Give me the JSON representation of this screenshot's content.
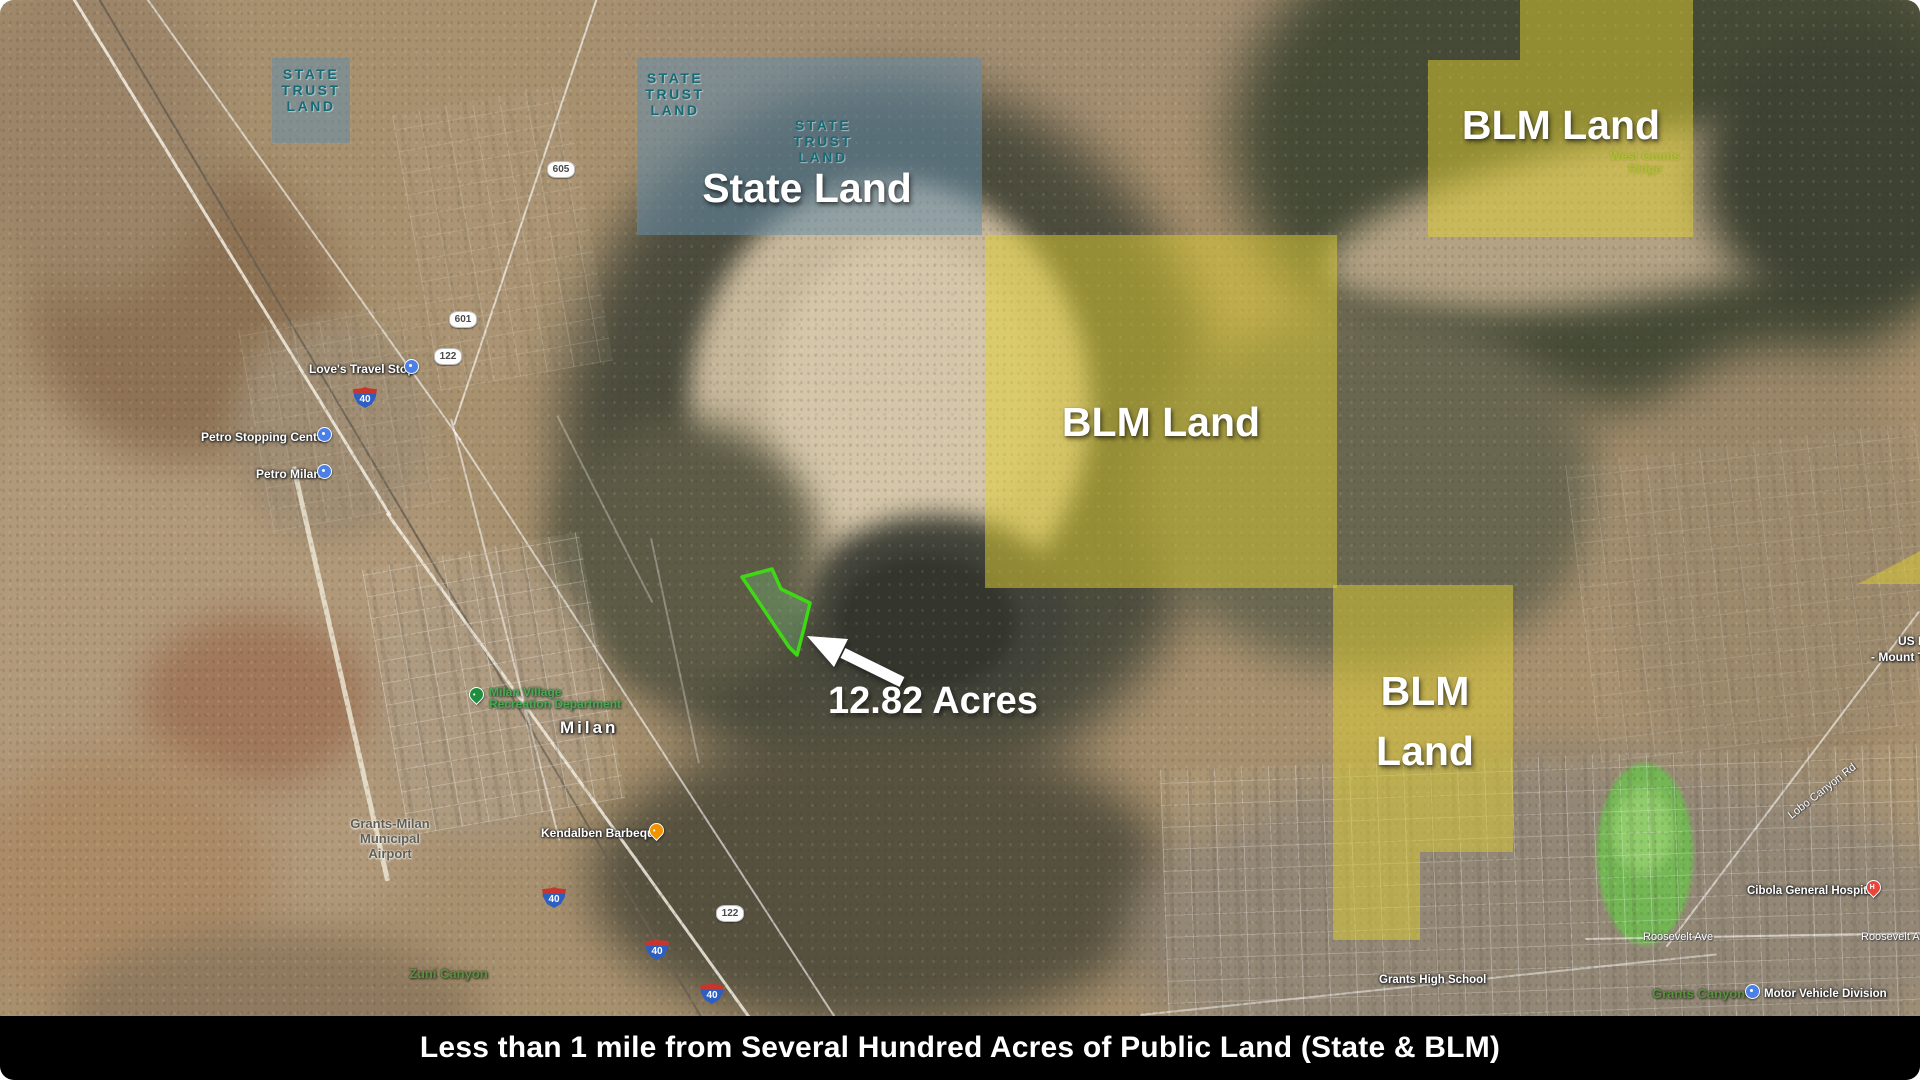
{
  "title_overlays": {
    "state_trust_lines": [
      "STATE",
      "TRUST",
      "LAND"
    ],
    "state_land": "State Land",
    "blm_center": "BLM Land",
    "blm_top_right": "BLM Land",
    "blm_right": [
      "BLM",
      "Land"
    ],
    "parcel_acreage": "12.82 Acres"
  },
  "caption": {
    "text": "Less than 1 mile from Several Hundred Acres of Public Land (State & BLM)"
  },
  "map_labels": {
    "loves_travel_stop": "Love's Travel Stop",
    "petro_stopping_center": "Petro Stopping Center",
    "petro_milan": "Petro Milan",
    "milan_rec_line1": "Milan Village",
    "milan_rec_line2": "Recreation Department",
    "milan": "Milan",
    "airport_line1": "Grants-Milan",
    "airport_line2": "Municipal",
    "airport_line3": "Airport",
    "kendalben": "Kendalben Barbeque",
    "zuni_canyon": "Zuni Canyon",
    "grants_high_school": "Grants High School",
    "cibola_hospital": "Cibola General Hospital",
    "roosevelt_ave": "Roosevelt Ave",
    "grants_canyon": "Grants Canyon",
    "motor_vehicle_division": "Motor Vehicle Division",
    "west_grants_ridge_line1": "West Grants",
    "west_grants_ridge_line2": "Ridge",
    "us_highway_fragment": "US F",
    "mount_taylor_fragment": "- Mount Ta",
    "lobo_canyon_rd": "Lobo Canyon Rd"
  },
  "shields": {
    "interstate_40": "40",
    "nm_605": "605",
    "nm_601": "601",
    "nm_122": "122"
  },
  "colors": {
    "state_overlay_blue": "#648CAA",
    "blm_overlay_yellow": "#E0D030",
    "parcel_outline_green": "#3FD815",
    "state_trust_text_teal": "#156A76",
    "caption_background": "#000000",
    "caption_text": "#FFFFFF"
  }
}
